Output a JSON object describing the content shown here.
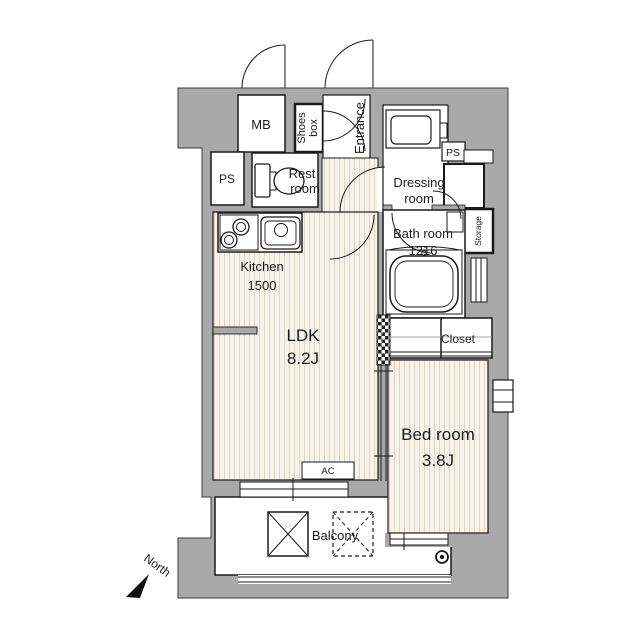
{
  "plan": {
    "type": "apartment-floor-plan",
    "colors": {
      "wall_gray": "#a9a9a9",
      "outline": "#1a1a1a",
      "floor": "#f7f3e8",
      "floor_stripe": "#ddd6c2"
    },
    "labels": {
      "mb": "MB",
      "shoes_line1": "Shoes",
      "shoes_line2": "box",
      "entrance": "Entrance",
      "ps_left": "PS",
      "rest_line1": "Rest",
      "rest_line2": "room",
      "dressing_line1": "Dressing",
      "dressing_line2": "room",
      "ps_right": "PS",
      "storage": "Storage",
      "bath_line1": "Bath room",
      "bath_line2": "1216",
      "kitchen_line1": "Kitchen",
      "kitchen_line2": "1500",
      "ldk_line1": "LDK",
      "ldk_line2": "8.2J",
      "closet": "Closet",
      "bedroom_line1": "Bed room",
      "bedroom_line2": "3.8J",
      "ac": "AC",
      "balcony": "Balcony",
      "north": "North"
    }
  }
}
